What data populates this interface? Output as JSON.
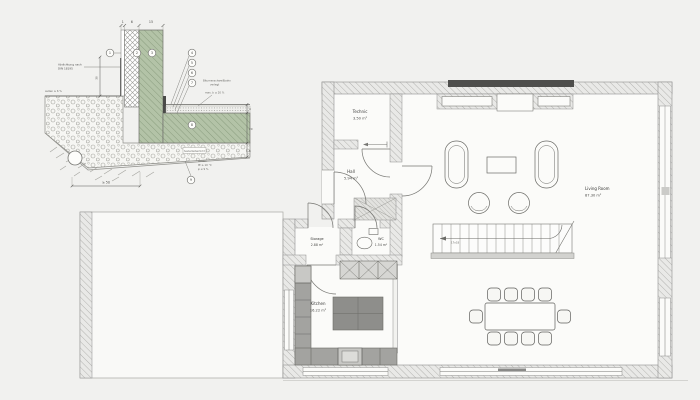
{
  "detail": {
    "dims": {
      "plaster": "1",
      "insulation": "6",
      "wall": "15",
      "height": "30",
      "layer_top": "4",
      "slab": "20",
      "bed": "6",
      "base": "≥ 50"
    },
    "labels": {
      "seal_1": "Abdichtung nach",
      "seal_2": "DIN 18195",
      "grade": "außen ≥ 6 %",
      "membrane_1": "Bitumenschweißbahn",
      "membrane_2": "verlegt",
      "membrane_3": "max. b ≤ 20 %",
      "soil_1": "außen:",
      "soil_2": "tE ≥ 10 °C",
      "soil_3": "φ ≤ 9 %",
      "layer_tag": "Sauberkeitsschicht"
    },
    "callouts": [
      "1",
      "2",
      "3",
      "4",
      "5",
      "6",
      "7",
      "8",
      "9"
    ]
  },
  "floorplan": {
    "rooms": {
      "technic": {
        "name": "Technic",
        "area": "3.50 m²"
      },
      "hall": {
        "name": "Hall",
        "area": "5.94 m²"
      },
      "storage": {
        "name": "Storage",
        "area": "2.88 m²"
      },
      "wc": {
        "name": "WC",
        "area": "1.54 m²"
      },
      "kitchen": {
        "name": "Kitchen",
        "area": "16.22 m²"
      },
      "living": {
        "name": "Living Room",
        "area": "87.30 m²"
      }
    },
    "stairs": {
      "note": "17x18"
    }
  },
  "colors": {
    "background": "#f1f1ef",
    "wall_hatch": "#b3b3b0",
    "concrete_green": "#b3c3a7",
    "dark_band": "#4e4e4c",
    "counter_gray": "#a3a3a0",
    "island_gray": "#8e8e8b"
  }
}
